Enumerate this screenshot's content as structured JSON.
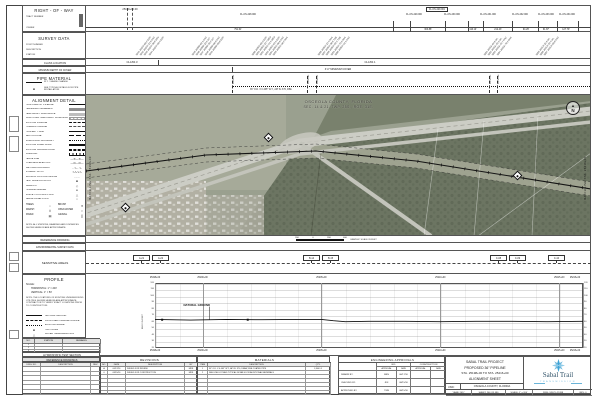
{
  "colors": {
    "line": "#555555",
    "logo_blue": "#3fa3d6",
    "logo_text": "#35566b",
    "aerial_base": "#9aa08f",
    "accent_dark": "#1a1a1a"
  },
  "row_band": {
    "title": "RIGHT - OF - WAY",
    "field1": "TRACT NUMBER",
    "field2": "OWNER",
    "stations": [
      {
        "label": "25199+00.00",
        "x": 130
      }
    ],
    "boxed_tract": {
      "label": "FL-OS-229.001",
      "x": 437
    },
    "tracts": [
      {
        "label": "FL-OS-228.000",
        "x": 248
      },
      {
        "label": "FL-OS-229.000",
        "x": 414
      },
      {
        "label": "FL-OS-230.000",
        "x": 452
      },
      {
        "label": "FL-OS-231.000",
        "x": 488
      },
      {
        "label": "FL-OS-232.000",
        "x": 520
      },
      {
        "label": "FL-OS-233.000",
        "x": 546
      },
      {
        "label": "FL-OS-234.000",
        "x": 567
      }
    ],
    "dividers": [
      393,
      410,
      445,
      468,
      483,
      512,
      538,
      557,
      578
    ],
    "distances": [
      {
        "label": "791.61'",
        "x": 238
      },
      {
        "label": "363.88'",
        "x": 428
      },
      {
        "label": "116.10'",
        "x": 473
      },
      {
        "label": "212.43'",
        "x": 498
      },
      {
        "label": "94.26'",
        "x": 526
      },
      {
        "label": "61.87'",
        "x": 546
      },
      {
        "label": "127.79'",
        "x": 566
      }
    ]
  },
  "survey_band": {
    "title": "SURVEY DATA",
    "fields": [
      "POINT NUMBER",
      "DESCRIPTION",
      "STATION"
    ],
    "clusters": [
      {
        "x": 136,
        "lines": [
          "1041 25199+08.2 EOP",
          "1042 25199+21.5 FNC",
          "1043 25199+36.0 DRV",
          "1044 25199+58.4 EOP"
        ]
      },
      {
        "x": 192,
        "lines": [
          "1045 25200+02.1 FNC",
          "1046 25200+18.9 DIT",
          "1047 25200+35.2 DIT",
          "1048 25200+66.8 FNC",
          "1049 25200+88.0 EOP"
        ]
      },
      {
        "x": 252,
        "lines": [
          "1050 25202+05.3 EOP",
          "1051 25202+22.7 MED",
          "1052 25202+41.9 MED",
          "1053 25202+63.1 EOP",
          "1054 25202+80.6 FNC",
          "1055 25202+96.2 R/W"
        ]
      },
      {
        "x": 318,
        "lines": [
          "1056 25204+12.4 R/W",
          "1057 25204+30.8 TOB",
          "1058 25204+52.3 TOB",
          "1059 25204+75.9 R/W",
          "1060 25204+91.1 FNC"
        ]
      },
      {
        "x": 484,
        "lines": [
          "1061 25211+04.6 WL",
          "1062 25211+28.3 WL",
          "1063 25211+49.7 FNC",
          "1064 25211+70.2 R/W"
        ]
      },
      {
        "x": 536,
        "lines": [
          "1065 25213+11.8 WL",
          "1066 25213+32.4 WL",
          "1067 25213+55.0 FNC"
        ]
      }
    ]
  },
  "class_band": {
    "title": "CLASS LOCATION",
    "labels": [
      {
        "label": "CLASS 3",
        "x": 132
      },
      {
        "label": "CLASS 1",
        "x": 370
      }
    ],
    "tick_x": 158
  },
  "cover_band": {
    "title": "MINIMUM DEPTH OF COVER",
    "label": "3'-0\" MINIMUM COVER",
    "label_x": 338,
    "tick_x": 232
  },
  "pipe_band": {
    "title": "PIPE MATERIAL",
    "legend": [
      {
        "sym": "line-thin",
        "label": "W.T. / GRADE CHANGE"
      },
      {
        "sym": "sym-square",
        "label": "SEE TYPICAL DETAILS FOR PIPE INSTALLATION"
      }
    ],
    "segment_label": "36\" O.D. X 0.465\" W.T., API 5L X70, FBE",
    "ticks": [
      {
        "x": 232,
        "label": "25203+21"
      },
      {
        "x": 307,
        "label": "25205+89"
      },
      {
        "x": 316,
        "label": "25206+21"
      },
      {
        "x": 489,
        "label": "25212+39"
      },
      {
        "x": 497,
        "label": "25212+68"
      }
    ]
  },
  "map": {
    "county_line1": "OSCEOLA COUNTY, FLORIDA",
    "county_line2": "SEC. 14 & 21, TWP. 25S., RGE. 31E.",
    "match_left": "MATCH LINE STA. 25198+00",
    "match_right": "MATCH LINE STA. 25216+00",
    "north_label": "N",
    "mileposts": [
      {
        "x": 268,
        "y": 137
      },
      {
        "x": 517,
        "y": 175
      },
      {
        "x": 125,
        "y": 207
      }
    ]
  },
  "reference_band": {
    "title": "REFERENCE DRAWING",
    "scale_numbers": [
      "200",
      "0",
      "200",
      "400"
    ],
    "scale_caption": "GRAPHIC SCALE IN FEET"
  },
  "environmental_band": {
    "title": "ENVIRONMENTAL SURVEY DATA"
  },
  "sensitive_band": {
    "title": "SENSITIVE AREAS",
    "tags": [
      {
        "label": "A-21",
        "x": 133
      },
      {
        "label": "A-22",
        "x": 152
      },
      {
        "label": "B-14",
        "x": 303
      },
      {
        "label": "B-15",
        "x": 322
      },
      {
        "label": "C-08",
        "x": 490
      },
      {
        "label": "C-09",
        "x": 509
      },
      {
        "label": "C-10",
        "x": 548
      }
    ]
  },
  "alignment_detail": {
    "title": "ALIGNMENT DETAIL",
    "items": [
      {
        "label": "PROPOSED 36\" PIPELINE",
        "sym": "line-thick"
      },
      {
        "label": "PERMANENT EASEMENT",
        "sym": "swatch-dark"
      },
      {
        "label": "TEMPORARY WORKSPACE",
        "sym": "swatch-mid"
      },
      {
        "label": "ADDITIONAL TEMPORARY WORKSPACE",
        "sym": "swatch-hatch"
      },
      {
        "label": "EXISTING PIPELINE",
        "sym": "line-dash"
      },
      {
        "label": "FOREIGN PIPELINE",
        "sym": "line-dashdot"
      },
      {
        "label": "PROPERTY LINE",
        "sym": "line-thin"
      },
      {
        "label": "SECTION LINE",
        "sym": "line-longdash"
      },
      {
        "label": "SUBDIVISION BOUNDARY",
        "sym": "line-dot"
      },
      {
        "label": "EXISTING PAVED ROAD",
        "sym": "line-double"
      },
      {
        "label": "EXISTING UNPAVED ROAD",
        "sym": "line-double-dash"
      },
      {
        "label": "RAILROAD",
        "sym": "line-rail"
      },
      {
        "label": "FENCE LINE",
        "sym": "line-x"
      },
      {
        "label": "OVERHEAD ELECTRIC",
        "sym": "line-ohe"
      },
      {
        "label": "WETLAND BOUNDARY",
        "sym": "line-wet"
      },
      {
        "label": "STREAM / DITCH",
        "sym": "line-stream"
      },
      {
        "label": "EROSION CONTROL DEVICE",
        "sym": "line-dot2"
      },
      {
        "label": "TEST BORE LOCATION",
        "sym": "sym-square"
      },
      {
        "label": "MILEPOST",
        "sym": "sym-diamond"
      },
      {
        "label": "PIPELINE MARKER",
        "sym": "sym-dot"
      },
      {
        "label": "SURVEY CONTROL POINT",
        "sym": "sym-tri"
      },
      {
        "label": "AERIAL PANEL POINT",
        "sym": "sym-circle"
      }
    ],
    "mini": [
      {
        "label": "TREES",
        "sym": "○"
      },
      {
        "label": "BRUSH",
        "sym": "✕"
      },
      {
        "label": "MARSH",
        "sym": "⌇⌇"
      },
      {
        "label": "OPEN WATER",
        "sym": "≈"
      },
      {
        "label": "PAVED",
        "sym": "▤"
      },
      {
        "label": "GRAVEL",
        "sym": "▒"
      }
    ],
    "note": "NOTE: ALL STATIONS, BEARINGS AND DISTANCES SHOWN HEREON ARE APPROXIMATE."
  },
  "profile_box": {
    "title": "PROFILE",
    "scale_label": "SCALE:",
    "scale1": "HORIZONTAL: 1\" = 200'",
    "scale2": "VERTICAL: 1\" = 50'",
    "note": "NOTE: THE LOCATIONS OF EXISTING UNDERGROUND UTILITIES SHOWN HEREON ARE APPROXIMATE. CONTRACTOR TO VERIFY EXACT LOCATIONS PRIOR TO CONSTRUCTION.",
    "legend": [
      {
        "label": "NATURAL GROUND",
        "sym": "line-thin"
      },
      {
        "label": "PROPOSED PIPELINE PROFILE",
        "sym": "line-dash"
      },
      {
        "label": "EXISTING GRADE",
        "sym": "line-dot"
      },
      {
        "label": "TEST BORE",
        "sym": "sym-square"
      },
      {
        "label": "WATER TABLE ELEVATION",
        "sym": "sym-tri"
      }
    ]
  },
  "mini_table": {
    "headers": [
      "NO.",
      "STATION",
      "REMARKS"
    ],
    "rows": [
      [
        "1",
        "",
        ""
      ],
      [
        "2",
        "",
        ""
      ],
      [
        "3",
        "",
        ""
      ]
    ]
  },
  "hydro_header": "HYDROSTATIC TEST SECTION",
  "ref_drawings": {
    "title": "REFERENCE DRAWINGS",
    "headers": [
      "DWG. NO.",
      "DESCRIPTION",
      "REV."
    ],
    "empty_rows": 6
  },
  "revisions": {
    "title": "REVISIONS",
    "headers": [
      "NO.",
      "DATE",
      "DESCRIPTION",
      "BY"
    ],
    "rows": [
      [
        "A",
        "06/17/16",
        "ISSUED FOR REVIEW",
        "MRS"
      ],
      [
        "0",
        "08/15/16",
        "ISSUED FOR CONSTRUCTION",
        "MRS"
      ]
    ],
    "empty_rows": 5
  },
  "materials": {
    "title": "MATERIALS",
    "headers": [
      "ITEM",
      "DESCRIPTION",
      "QTY."
    ],
    "rows": [
      [
        "1",
        "36\" O.D. X 0.465\" W.T., API 5L X70, DSAW, FBE COATED PIPE",
        "1,800 LF"
      ],
      [
        "2",
        "SEE LINE LIST AND TYPICAL DETAILS FOR ADDITIONAL MATERIALS",
        ""
      ]
    ],
    "empty_rows": 5
  },
  "approvals": {
    "title": "ENGINEERING APPROVALS",
    "col_bid": "BID",
    "col_con": "CONSTRUCTION",
    "sub": [
      "APPROVAL",
      "DATE",
      "APPROVAL",
      "DATE"
    ],
    "rows": [
      [
        "DRAWN BY:",
        "MRS",
        "06/17/16",
        "",
        ""
      ],
      [
        "CHECKED BY:",
        "JDF",
        "08/15/16",
        "",
        ""
      ],
      [
        "APPROVED BY:",
        "TWB",
        "08/15/16",
        "",
        ""
      ]
    ]
  },
  "title_block": {
    "line1": "SABAL TRAIL PROJECT",
    "line2": "PROPOSED 36\" PIPELINE",
    "line3": "STA. 25198+00 TO STA. 25216+00",
    "line4": "ALIGNMENT SHEET",
    "usid_label": "USID:",
    "location": "OSCEOLA COUNTY, FLORIDA",
    "logo_name": "Sabal Trail",
    "logo_sub": "TRANSMISSION",
    "footer": {
      "year": "YEAR: 2017",
      "sheet": "SHEET: 246 OF 480",
      "scale": "SCALE: 1\" = 200'",
      "dwg": "DWG: SW-PL-25198",
      "rev": "REV: 0"
    }
  },
  "left_strip": [
    {
      "y": 116,
      "h": 16
    },
    {
      "y": 136,
      "h": 16
    },
    {
      "y": 252,
      "h": 9
    },
    {
      "y": 263,
      "h": 9
    },
    {
      "y": 330,
      "h": 9
    }
  ],
  "chart_data": {
    "type": "line",
    "title": "PROFILE",
    "ylabel": "ELEV. IN FEET",
    "ylim": [
      20,
      120
    ],
    "yticks": [
      20,
      30,
      40,
      50,
      60,
      70,
      80,
      90,
      100,
      110,
      120
    ],
    "x_start_ft": 0,
    "x_end_ft": 1800,
    "x_ticks": [
      {
        "ft": 0,
        "label": "25198+00"
      },
      {
        "ft": 200,
        "label": "25200+00"
      },
      {
        "ft": 700,
        "label": "25205+00"
      },
      {
        "ft": 1200,
        "label": "25210+00"
      },
      {
        "ft": 1700,
        "label": "25215+00"
      },
      {
        "ft": 1800,
        "label": "25216+00"
      }
    ],
    "series": [
      {
        "name": "NATURAL GROUND",
        "x_ft": [
          0,
          150,
          300,
          450,
          600,
          700,
          750,
          800,
          900,
          1050,
          1200,
          1350,
          1500,
          1650,
          1800
        ],
        "elev_ft": [
          64,
          63,
          64,
          63.5,
          64,
          64,
          62,
          60.5,
          61,
          61,
          60.5,
          61,
          61,
          60.5,
          61
        ]
      }
    ],
    "annotation": {
      "text": "NATURAL GROUND",
      "x_ft": 120,
      "elev_ft": 86,
      "leader_to_x_ft": 230,
      "leader_to_elev_ft": 63.5
    },
    "markers": [
      {
        "x_ft": 30,
        "elev_ft": 63.5
      },
      {
        "x_ft": 390,
        "elev_ft": 63.5
      }
    ]
  }
}
